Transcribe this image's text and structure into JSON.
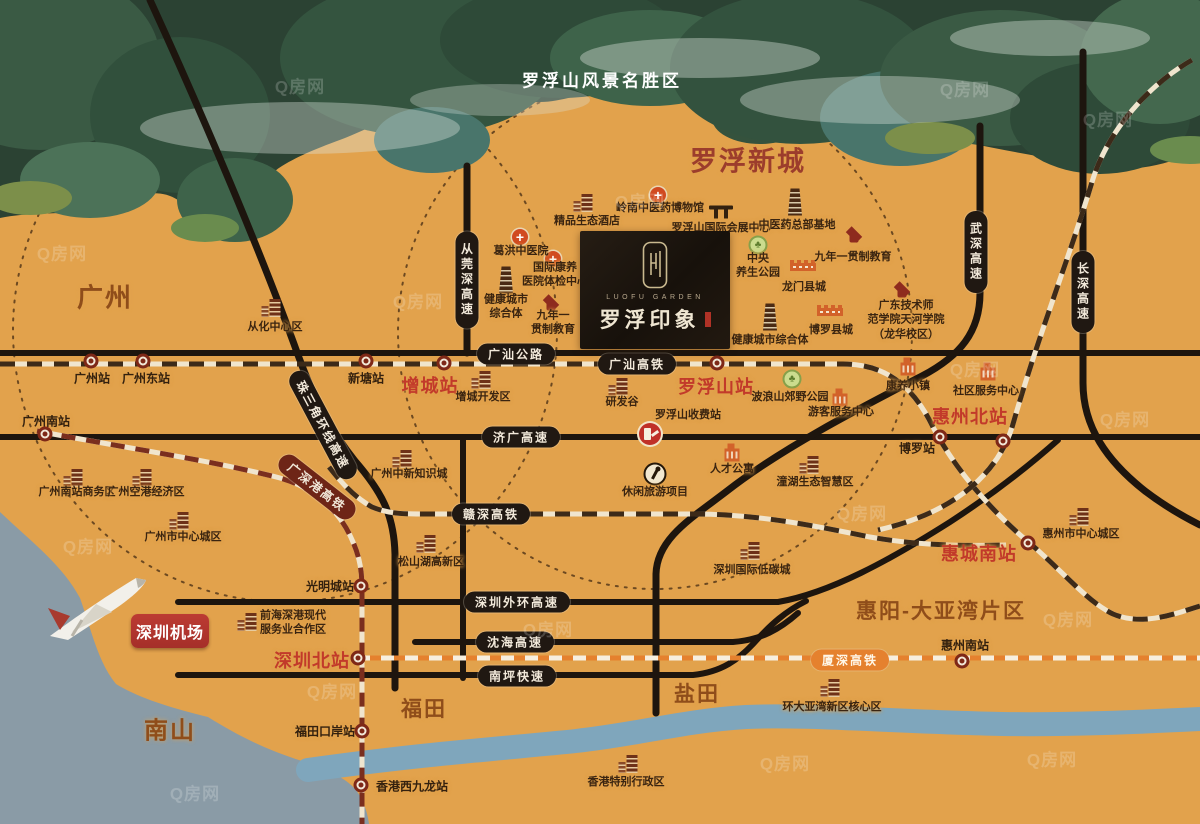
{
  "scenic_title": "罗浮山风景名胜区",
  "watermark_text": "Q房网",
  "logo": {
    "en": "LUOFU GARDEN",
    "cn": "罗浮印象"
  },
  "airport": {
    "label": "深圳机场"
  },
  "colors": {
    "map_bg": "#E2A24C",
    "road": "#1D150E",
    "rail_base": "#F0E5CE",
    "rail_dash": "#3C2A19",
    "hsr_maroon": "#7A2E1E",
    "xiashen_orange": "#E5812E",
    "station_red": "#C23A2A",
    "area_brown": "#8F4D1A",
    "new_town_red": "#9C3D2C",
    "sea": "#8A9BA6",
    "river": "#7FA6BC",
    "banner_red": "#B23530",
    "logo_bg": "#1A130D"
  },
  "areas": [
    {
      "label": "广州",
      "x": 105,
      "y": 296,
      "fs": 26,
      "c": "#8F4D1A"
    },
    {
      "label": "罗浮新城",
      "x": 748,
      "y": 159,
      "fs": 27,
      "c": "#9C3D2C"
    },
    {
      "label": "南山",
      "x": 170,
      "y": 728,
      "fs": 24,
      "c": "#8F4D1A"
    },
    {
      "label": "福田",
      "x": 424,
      "y": 708,
      "fs": 21,
      "c": "#8F4D1A"
    },
    {
      "label": "盐田",
      "x": 697,
      "y": 693,
      "fs": 21,
      "c": "#8F4D1A"
    },
    {
      "label": "惠阳-大亚湾片区",
      "x": 941,
      "y": 610,
      "fs": 21,
      "c": "#8F4D1A"
    }
  ],
  "station_labels": [
    {
      "label": "广州站",
      "x": 92,
      "y": 378,
      "cls": "dk"
    },
    {
      "label": "广州东站",
      "x": 146,
      "y": 378,
      "cls": "dk"
    },
    {
      "label": "新塘站",
      "x": 366,
      "y": 378,
      "cls": "dk"
    },
    {
      "label": "增城站",
      "x": 430,
      "y": 385,
      "cls": "red"
    },
    {
      "label": "罗浮山站",
      "x": 716,
      "y": 386,
      "cls": "red"
    },
    {
      "label": "广州南站",
      "x": 46,
      "y": 421,
      "cls": "dk"
    },
    {
      "label": "光明城站",
      "x": 330,
      "y": 586,
      "cls": "dk"
    },
    {
      "label": "深圳北站",
      "x": 312,
      "y": 660,
      "cls": "red"
    },
    {
      "label": "福田口岸站",
      "x": 325,
      "y": 731,
      "cls": "dk"
    },
    {
      "label": "香港西九龙站",
      "x": 412,
      "y": 786,
      "cls": "dk"
    },
    {
      "label": "博罗站",
      "x": 917,
      "y": 448,
      "cls": "dk"
    },
    {
      "label": "惠州北站",
      "x": 970,
      "y": 416,
      "cls": "red"
    },
    {
      "label": "惠城南站",
      "x": 979,
      "y": 553,
      "cls": "red"
    },
    {
      "label": "惠州南站",
      "x": 965,
      "y": 645,
      "cls": "dk"
    }
  ],
  "station_icons": [
    {
      "x": 91,
      "y": 361
    },
    {
      "x": 143,
      "y": 361
    },
    {
      "x": 366,
      "y": 361
    },
    {
      "x": 444,
      "y": 363
    },
    {
      "x": 717,
      "y": 363
    },
    {
      "x": 45,
      "y": 434
    },
    {
      "x": 361,
      "y": 586
    },
    {
      "x": 358,
      "y": 658
    },
    {
      "x": 362,
      "y": 731
    },
    {
      "x": 361,
      "y": 785
    },
    {
      "x": 940,
      "y": 437
    },
    {
      "x": 1003,
      "y": 441
    },
    {
      "x": 1028,
      "y": 543
    },
    {
      "x": 962,
      "y": 661
    }
  ],
  "poi_labels": [
    {
      "label": "精品生态酒店",
      "x": 587,
      "y": 221
    },
    {
      "label": "岭南中医药博物馆",
      "x": 660,
      "y": 208
    },
    {
      "label": "罗浮山国际会展中心",
      "x": 721,
      "y": 228
    },
    {
      "label": "中医药总部基地",
      "x": 797,
      "y": 225
    },
    {
      "label": "中央\n养生公园",
      "x": 758,
      "y": 266
    },
    {
      "label": "九年一贯制教育",
      "x": 853,
      "y": 257
    },
    {
      "label": "龙门县城",
      "x": 804,
      "y": 287
    },
    {
      "label": "博罗县城",
      "x": 831,
      "y": 330
    },
    {
      "label": "广东技术师\n范学院天河学院\n（龙华校区）",
      "x": 906,
      "y": 320
    },
    {
      "label": "健康城市综合体",
      "x": 770,
      "y": 340
    },
    {
      "label": "葛洪中医院",
      "x": 521,
      "y": 251
    },
    {
      "label": "国际康养\n医院体检中心",
      "x": 555,
      "y": 275
    },
    {
      "label": "健康城市\n综合体",
      "x": 506,
      "y": 307
    },
    {
      "label": "九年一\n贯制教育",
      "x": 553,
      "y": 323
    },
    {
      "label": "从化中心区",
      "x": 275,
      "y": 327
    },
    {
      "label": "增城开发区",
      "x": 483,
      "y": 397
    },
    {
      "label": "研发谷",
      "x": 622,
      "y": 402
    },
    {
      "label": "罗浮山收费站",
      "x": 688,
      "y": 415
    },
    {
      "label": "人才公寓",
      "x": 732,
      "y": 469
    },
    {
      "label": "休闲旅游项目",
      "x": 655,
      "y": 492
    },
    {
      "label": "广州中新知识城",
      "x": 409,
      "y": 474
    },
    {
      "label": "广州南站商务区",
      "x": 77,
      "y": 492
    },
    {
      "label": "广州空港经济区",
      "x": 146,
      "y": 492
    },
    {
      "label": "广州市中心城区",
      "x": 183,
      "y": 537
    },
    {
      "label": "松山湖高新区",
      "x": 431,
      "y": 562
    },
    {
      "label": "潼湖生态智慧区",
      "x": 815,
      "y": 482
    },
    {
      "label": "深圳国际低碳城",
      "x": 752,
      "y": 570
    },
    {
      "label": "惠州市中心城区",
      "x": 1081,
      "y": 534
    },
    {
      "label": "康养小镇",
      "x": 908,
      "y": 386
    },
    {
      "label": "社区服务中心",
      "x": 986,
      "y": 391
    },
    {
      "label": "游客服务中心",
      "x": 841,
      "y": 412
    },
    {
      "label": "波浪山郊野公园",
      "x": 790,
      "y": 397
    },
    {
      "label": "前海深港现代\n服务业合作区",
      "x": 293,
      "y": 623
    },
    {
      "label": "环大亚湾新区核心区",
      "x": 832,
      "y": 707
    },
    {
      "label": "香港特别行政区",
      "x": 626,
      "y": 782
    }
  ],
  "poi_icons": [
    {
      "t": "building",
      "x": 587,
      "y": 203
    },
    {
      "t": "cross",
      "x": 658,
      "y": 195
    },
    {
      "t": "gate",
      "x": 721,
      "y": 212
    },
    {
      "t": "tower",
      "x": 795,
      "y": 202
    },
    {
      "t": "park",
      "x": 758,
      "y": 245
    },
    {
      "t": "cap",
      "x": 854,
      "y": 235
    },
    {
      "t": "wall",
      "x": 803,
      "y": 267
    },
    {
      "t": "wall",
      "x": 830,
      "y": 312
    },
    {
      "t": "cap",
      "x": 902,
      "y": 290
    },
    {
      "t": "tower",
      "x": 770,
      "y": 317
    },
    {
      "t": "cross",
      "x": 520,
      "y": 237
    },
    {
      "t": "cross",
      "x": 553,
      "y": 259
    },
    {
      "t": "tower",
      "x": 506,
      "y": 280
    },
    {
      "t": "cap",
      "x": 551,
      "y": 303
    },
    {
      "t": "building",
      "x": 275,
      "y": 308
    },
    {
      "t": "building",
      "x": 485,
      "y": 380
    },
    {
      "t": "building",
      "x": 622,
      "y": 387
    },
    {
      "t": "toll",
      "x": 650,
      "y": 434
    },
    {
      "t": "blocks",
      "x": 732,
      "y": 455
    },
    {
      "t": "leisure",
      "x": 655,
      "y": 474
    },
    {
      "t": "building",
      "x": 406,
      "y": 459
    },
    {
      "t": "building",
      "x": 77,
      "y": 478
    },
    {
      "t": "building",
      "x": 146,
      "y": 478
    },
    {
      "t": "building",
      "x": 183,
      "y": 521
    },
    {
      "t": "building",
      "x": 430,
      "y": 544
    },
    {
      "t": "building",
      "x": 813,
      "y": 465
    },
    {
      "t": "building",
      "x": 754,
      "y": 551
    },
    {
      "t": "building",
      "x": 1083,
      "y": 517
    },
    {
      "t": "blocks",
      "x": 908,
      "y": 369
    },
    {
      "t": "blocks",
      "x": 988,
      "y": 374
    },
    {
      "t": "blocks",
      "x": 840,
      "y": 400
    },
    {
      "t": "park",
      "x": 792,
      "y": 379
    },
    {
      "t": "building",
      "x": 251,
      "y": 622
    },
    {
      "t": "building",
      "x": 834,
      "y": 688
    },
    {
      "t": "building",
      "x": 632,
      "y": 764
    }
  ],
  "pills": [
    {
      "label": "广汕公路",
      "x": 516,
      "y": 354,
      "cls": ""
    },
    {
      "label": "广汕高铁",
      "x": 637,
      "y": 364,
      "cls": ""
    },
    {
      "label": "济广高速",
      "x": 521,
      "y": 437,
      "cls": ""
    },
    {
      "label": "赣深高铁",
      "x": 491,
      "y": 514,
      "cls": ""
    },
    {
      "label": "深圳外环高速",
      "x": 517,
      "y": 602,
      "cls": ""
    },
    {
      "label": "沈海高速",
      "x": 515,
      "y": 642,
      "cls": ""
    },
    {
      "label": "南坪快速",
      "x": 517,
      "y": 676,
      "cls": ""
    },
    {
      "label": "从莞深高速",
      "x": 467,
      "y": 280,
      "cls": "v"
    },
    {
      "label": "武深高速",
      "x": 976,
      "y": 252,
      "cls": "v"
    },
    {
      "label": "长深高速",
      "x": 1083,
      "y": 292,
      "cls": "v"
    },
    {
      "label": "珠三角环线高速",
      "x": 323,
      "y": 425,
      "cls": "r62"
    },
    {
      "label": "广深港高铁",
      "x": 317,
      "y": 487,
      "cls": "r38 maroon"
    },
    {
      "label": "厦深高铁",
      "x": 850,
      "y": 660,
      "cls": "orange"
    }
  ],
  "watermarks": [
    {
      "x": 300,
      "y": 85
    },
    {
      "x": 965,
      "y": 88
    },
    {
      "x": 62,
      "y": 252
    },
    {
      "x": 640,
      "y": 200
    },
    {
      "x": 975,
      "y": 368
    },
    {
      "x": 88,
      "y": 545
    },
    {
      "x": 548,
      "y": 628
    },
    {
      "x": 862,
      "y": 512
    },
    {
      "x": 1108,
      "y": 118
    },
    {
      "x": 1125,
      "y": 418
    },
    {
      "x": 332,
      "y": 690
    },
    {
      "x": 785,
      "y": 762
    },
    {
      "x": 1068,
      "y": 618
    },
    {
      "x": 195,
      "y": 792
    },
    {
      "x": 1052,
      "y": 758
    },
    {
      "x": 418,
      "y": 300
    }
  ]
}
